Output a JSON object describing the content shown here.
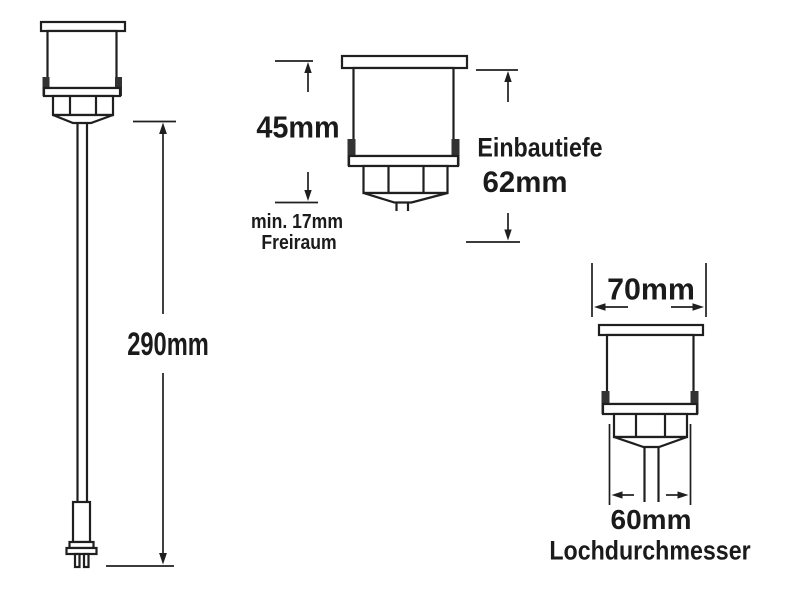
{
  "diagram": {
    "colors": {
      "background": "#ffffff",
      "line": "#1f1f1f",
      "clip_fill": "#333333",
      "text": "#1b1b1b"
    },
    "left_view": {
      "cable_length_label": "290mm"
    },
    "middle_view": {
      "height_label": "45mm",
      "clearance_label_line1": "min. 17mm",
      "clearance_label_line2": "Freiraum",
      "depth_label": "Einbautiefe",
      "depth_value_label": "62mm"
    },
    "right_view": {
      "width_label": "70mm",
      "hole_diameter_label": "60mm",
      "hole_diameter_caption": "Lochdurchmesser"
    }
  }
}
